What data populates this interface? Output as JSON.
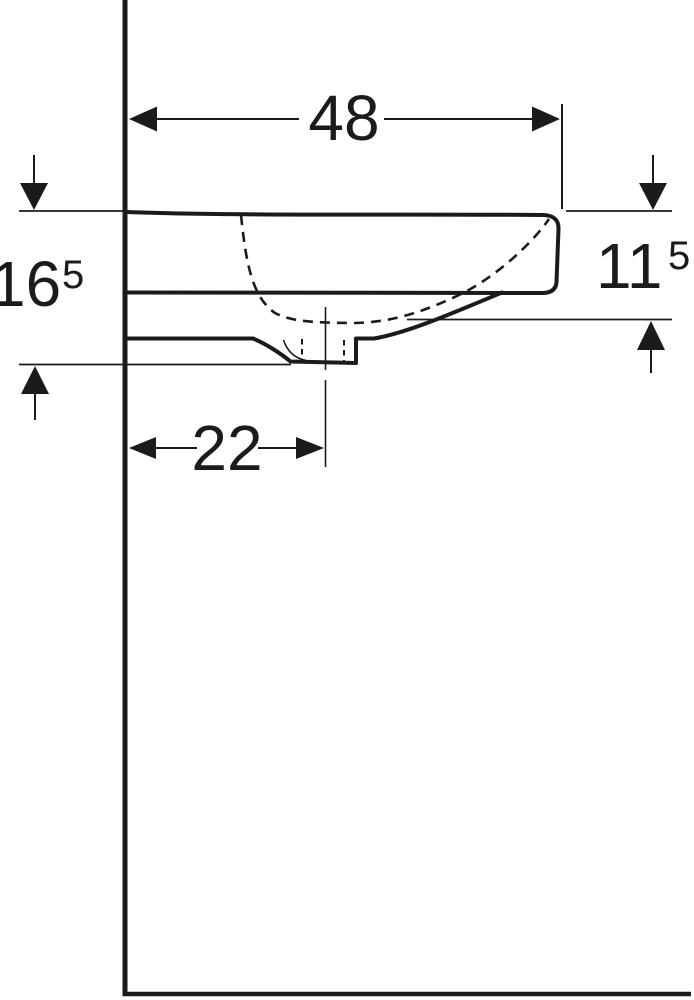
{
  "colors": {
    "background": "#ffffff",
    "line": "#1b1b1b"
  },
  "dimensions": {
    "top_width": {
      "value": "48"
    },
    "left_height": {
      "value": "16",
      "superscript": "5"
    },
    "right_height": {
      "value": "11",
      "superscript": "5"
    },
    "drain_center_offset": {
      "value": "22"
    }
  }
}
